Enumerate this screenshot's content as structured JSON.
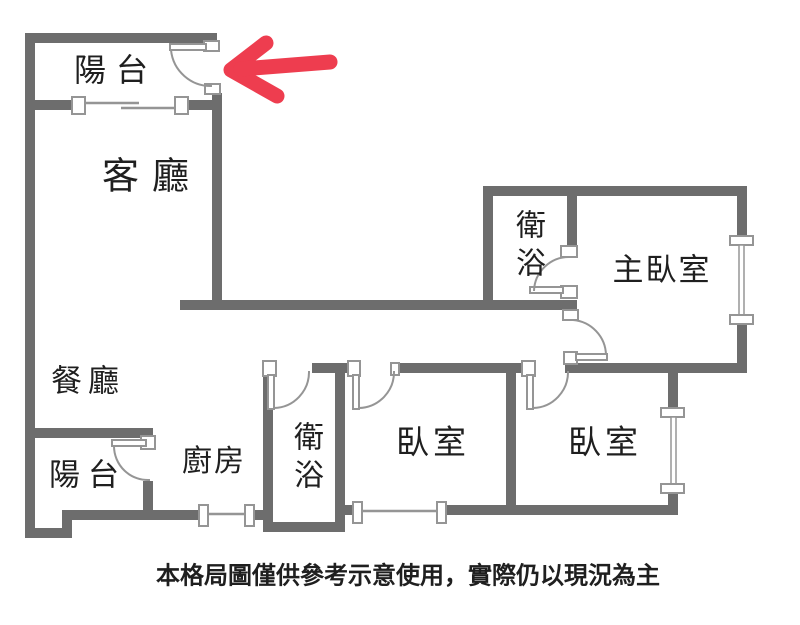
{
  "colors": {
    "wall": "#6d6d6d",
    "line": "#959595",
    "text": "#1f1f1f",
    "arrow": "#ee3d4f",
    "bg": "#ffffff"
  },
  "rooms": {
    "balcony_top": {
      "label": "陽台"
    },
    "living": {
      "label": "客廳"
    },
    "dining": {
      "label": "餐廳"
    },
    "balcony_bottom": {
      "label": "陽台"
    },
    "kitchen": {
      "label": "廚房"
    },
    "bathroom_top": {
      "label": "衛浴"
    },
    "bathroom_bottom": {
      "label": "衛浴"
    },
    "bedroom_left": {
      "label": "臥室"
    },
    "bedroom_right": {
      "label": "臥室"
    },
    "master_bedroom": {
      "label": "主臥室"
    }
  },
  "footer": {
    "disclaimer": "本格局圖僅供參考示意使用，實際仍以現況為主"
  }
}
